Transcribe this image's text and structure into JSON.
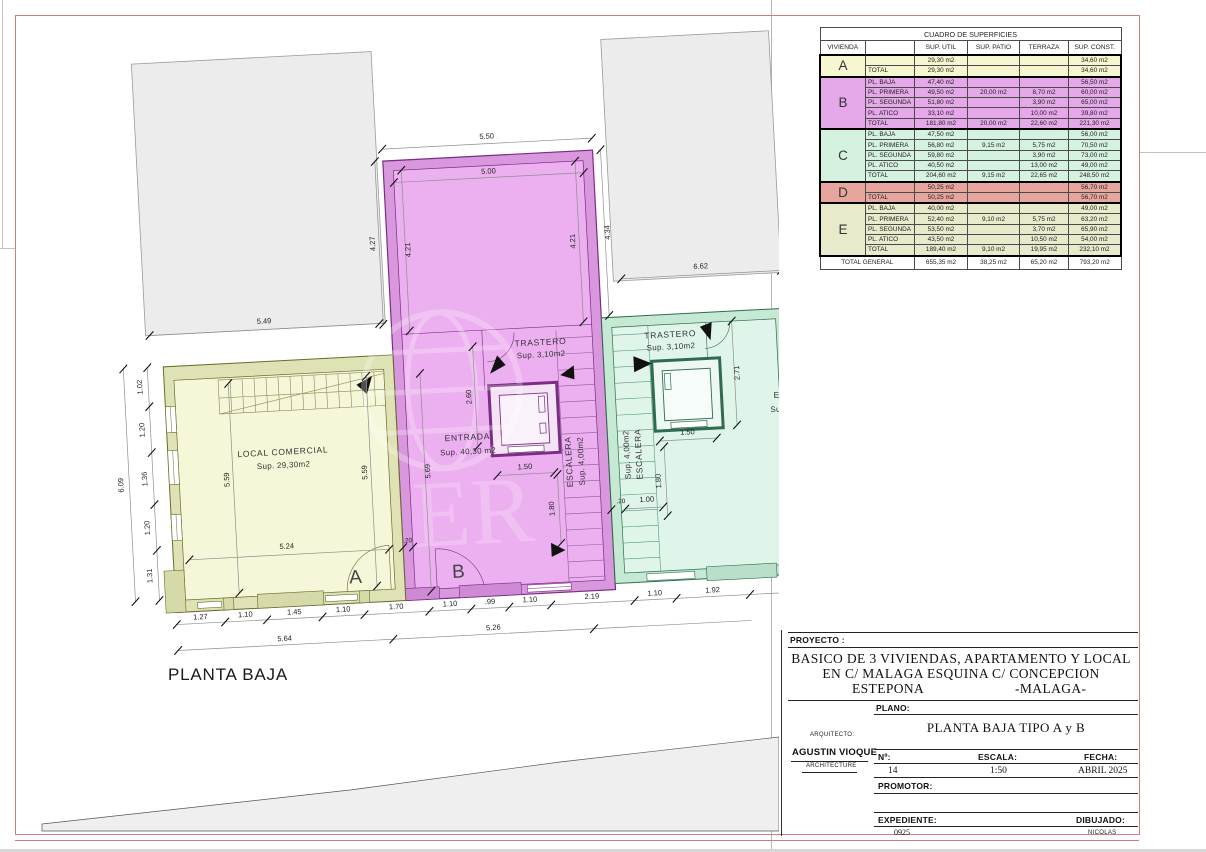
{
  "page": {
    "plan_label": "PLANTA BAJA"
  },
  "watermark": {
    "text": "ER"
  },
  "colors": {
    "frame_red": "#c9807e",
    "unit_a": "#f5f7d8",
    "unit_b": "#ecaff0",
    "unit_c": "#e0f5ea",
    "unit_d": "#e6a69e",
    "unit_e": "#e9e9cc"
  },
  "table": {
    "title": "CUADRO DE SUPERFICIES",
    "headers": [
      "VIVIENDA",
      "",
      "SUP. UTIL",
      "SUP. PATIO",
      "TERRAZA",
      "SUP. CONST."
    ],
    "groups": [
      {
        "letter": "A",
        "color": "#f6f7d0",
        "rows": [
          [
            "",
            "29,30 m2",
            "",
            "",
            "34,60 m2"
          ],
          [
            "TOTAL",
            "29,30 m2",
            "",
            "",
            "34,60 m2"
          ]
        ]
      },
      {
        "letter": "B",
        "color": "#e5a9e9",
        "rows": [
          [
            "PL. BAJA",
            "47,40 m2",
            "",
            "",
            "56,50 m2"
          ],
          [
            "PL. PRIMERA",
            "49,50 m2",
            "20,00 m2",
            "8,70 m2",
            "60,00 m2"
          ],
          [
            "PL. SEGUNDA",
            "51,80 m2",
            "",
            "3,90 m2",
            "65,00 m2"
          ],
          [
            "PL. ATICO",
            "33,10 m2",
            "",
            "10,00 m2",
            "39,80 m2"
          ],
          [
            "TOTAL",
            "181,80 m2",
            "20,00 m2",
            "22,60 m2",
            "221,30 m2"
          ]
        ]
      },
      {
        "letter": "C",
        "color": "#d5f1e0",
        "rows": [
          [
            "PL. BAJA",
            "47,50 m2",
            "",
            "",
            "56,00 m2"
          ],
          [
            "PL. PRIMERA",
            "56,80 m2",
            "9,15 m2",
            "5,75 m2",
            "70,50 m2"
          ],
          [
            "PL. SEGUNDA",
            "59,80 m2",
            "",
            "3,90 m2",
            "73,00 m2"
          ],
          [
            "PL. ATICO",
            "40,50 m2",
            "",
            "13,00 m2",
            "49,00 m2"
          ],
          [
            "TOTAL",
            "204,60 m2",
            "9,15 m2",
            "22,65 m2",
            "248,50 m2"
          ]
        ]
      },
      {
        "letter": "D",
        "color": "#e6a69e",
        "rows": [
          [
            "",
            "50,25 m2",
            "",
            "",
            "56,70 m2"
          ],
          [
            "TOTAL",
            "50,25 m2",
            "",
            "",
            "56,70 m2"
          ]
        ]
      },
      {
        "letter": "E",
        "color": "#e9e9cc",
        "rows": [
          [
            "PL. BAJA",
            "40,00 m2",
            "",
            "",
            "49,00 m2"
          ],
          [
            "PL. PRIMERA",
            "52,40 m2",
            "9,10 m2",
            "5,75 m2",
            "63,20 m2"
          ],
          [
            "PL. SEGUNDA",
            "53,50 m2",
            "",
            "3,70 m2",
            "65,90 m2"
          ],
          [
            "PL. ATICO",
            "43,50 m2",
            "",
            "10,50 m2",
            "54,00 m2"
          ],
          [
            "TOTAL",
            "189,40 m2",
            "9,10 m2",
            "19,95 m2",
            "232,10 m2"
          ]
        ]
      }
    ],
    "total_row": [
      "TOTAL GENERAL",
      "655,35 m2",
      "38,25 m2",
      "65,20 m2",
      "793,20 m2"
    ]
  },
  "title_block": {
    "proyecto_label": "PROYECTO :",
    "project_line1": "BASICO DE 3 VIVIENDAS, APARTAMENTO Y LOCAL",
    "project_line2": "EN  C/ MALAGA ESQUINA C/ CONCEPCION",
    "project_line3a": "ESTEPONA",
    "project_line3b": "-MALAGA-",
    "plano_label": "PLANO:",
    "plano_value": "PLANTA BAJA TIPO A y B",
    "arquitecto_label": "ARQUITECTO:",
    "arquitecto_name": "AGUSTIN VIOQUE",
    "arquitecto_sub": "ARCHITECTURE",
    "num_label": "Nº:",
    "num_value": "14",
    "escala_label": "ESCALA:",
    "escala_value": "1:50",
    "fecha_label": "FECHA:",
    "fecha_value": "ABRIL 2025",
    "promotor_label": "PROMOTOR:",
    "expediente_label": "EXPEDIENTE:",
    "expediente_value": "0925",
    "dibujado_label": "DIBUJADO:",
    "dibujado_value": "NICOLAS"
  },
  "plan": {
    "rooms": {
      "local": {
        "name": "LOCAL COMERCIAL",
        "area": "Sup. 29,30m2"
      },
      "entrada": {
        "name": "ENTRADA",
        "area": "Sup. 40,30 m2"
      },
      "trastero_b": {
        "name": "TRASTERO",
        "area": "Sup. 3,10m2"
      },
      "escalera_b": {
        "name": "ESCALERA",
        "area": "Sup. 4,00m2"
      },
      "trastero_c": {
        "name": "TRASTERO",
        "area": "Sup. 3,10m2"
      },
      "escalera_c": {
        "name": "ESCALERA",
        "area": "Sup. 4,00m2"
      }
    },
    "unit_labels": {
      "a": "A",
      "b": "B"
    },
    "dims": {
      "left_chain": [
        "1.02",
        "1.20",
        "1.36",
        "1.20",
        "1.31"
      ],
      "left_total": "6.09",
      "top_gray_left": "5.49",
      "tower_outer_w": "5.50",
      "tower_inner_w": "5.00",
      "tower_outer_l": "4.27",
      "tower_inner_l": "4.21",
      "tower_inner_r": "4.21",
      "tower_outer_r": "4.34",
      "top_gray_right": "6.62",
      "local_h_left": "5.59",
      "local_h_right": "5.59",
      "local_w": "5.24",
      "entrada_h": "5.69",
      "lift_b_h": "2.60",
      "lift_b_w": "1.50",
      "stair_b": "1.80",
      "wall_b": ".20",
      "lift_c_h": "2.71",
      "lift_c_w": "1.50",
      "stair_c": "1.80",
      "stair_c_w": "1.00",
      "wall_c": ".20",
      "bottom_chain": [
        "1.27",
        "1.10",
        "1.45",
        "1.10",
        "1.70",
        "1.10",
        ".99",
        "1.10",
        "2.19",
        "1.10",
        "1.92"
      ],
      "bottom_spans": [
        "5.64",
        "5.26"
      ],
      "partial_right_1": "E",
      "partial_right_2": "Su"
    }
  }
}
